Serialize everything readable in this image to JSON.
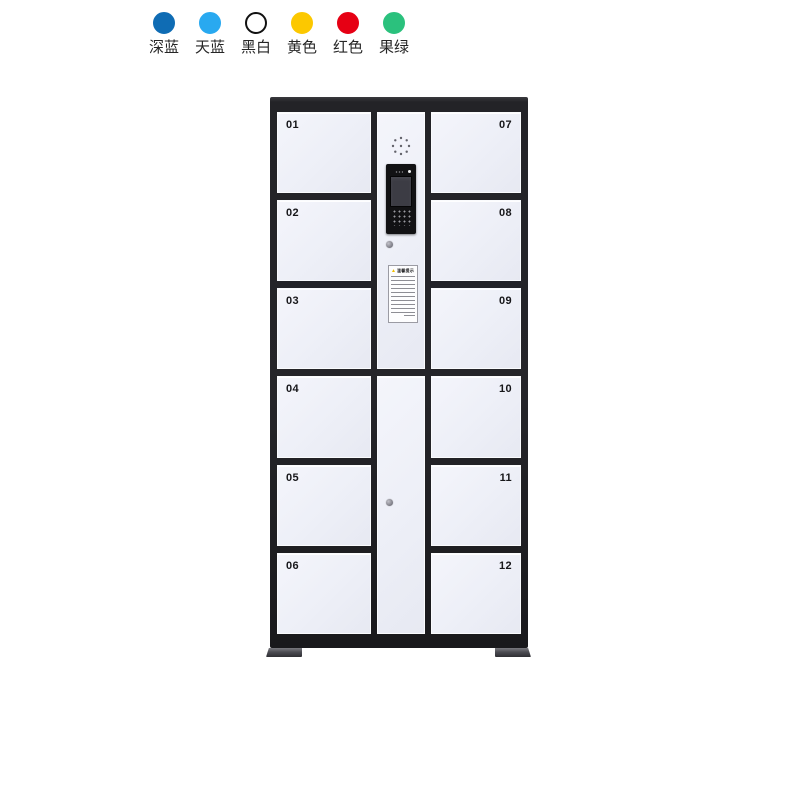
{
  "color_options": {
    "items": [
      {
        "name": "deep-blue",
        "label": "深蓝",
        "color": "#0f6cb4",
        "border": "#0f6cb4"
      },
      {
        "name": "sky-blue",
        "label": "天蓝",
        "color": "#29a9f0",
        "border": "#29a9f0"
      },
      {
        "name": "black-white",
        "label": "黑白",
        "color": "#ffffff",
        "border": "#111111"
      },
      {
        "name": "yellow",
        "label": "黄色",
        "color": "#fcc800",
        "border": "#fcc800"
      },
      {
        "name": "red",
        "label": "红色",
        "color": "#e60014",
        "border": "#e60014"
      },
      {
        "name": "fruit-green",
        "label": "果绿",
        "color": "#2bc17d",
        "border": "#2bc17d"
      }
    ]
  },
  "locker": {
    "left_doors": [
      "01",
      "02",
      "03",
      "04",
      "05",
      "06"
    ],
    "right_doors": [
      "07",
      "08",
      "09",
      "10",
      "11",
      "12"
    ],
    "panel": {
      "warning_title": "温馨提示"
    },
    "colors": {
      "frame": "#232327",
      "door": "#eef0f7",
      "warning_accent": "#f2bf00"
    }
  }
}
